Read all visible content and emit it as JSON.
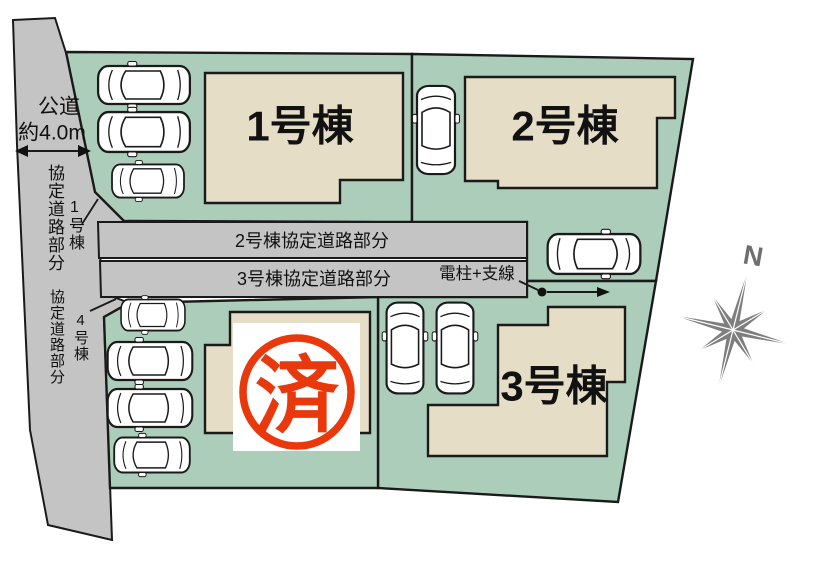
{
  "site_plan": {
    "road": {
      "name": "公道",
      "width": "約4.0m"
    },
    "left_labels": {
      "agreement_road_top": "協定道路部分",
      "agreement_road_top_target": "1号棟",
      "agreement_road_bottom": "協定道路部分",
      "agreement_road_bottom_target": "4号棟"
    },
    "strips": [
      {
        "label": "2号棟協定道路部分"
      },
      {
        "label": "3号棟協定道路部分"
      }
    ],
    "utility_label": "電柱+支線",
    "buildings": [
      {
        "label": "1号棟"
      },
      {
        "label": "2号棟"
      },
      {
        "label": "3号棟"
      }
    ],
    "sold_stamp": "済",
    "compass": {
      "north": "N"
    },
    "colors": {
      "lot_green": "#adcdbb",
      "building_beige": "#e6ddc6",
      "road_gray": "#c4c4c4",
      "stamp_red": "#e8380c",
      "compass_gray": "#7e7e7e"
    }
  }
}
